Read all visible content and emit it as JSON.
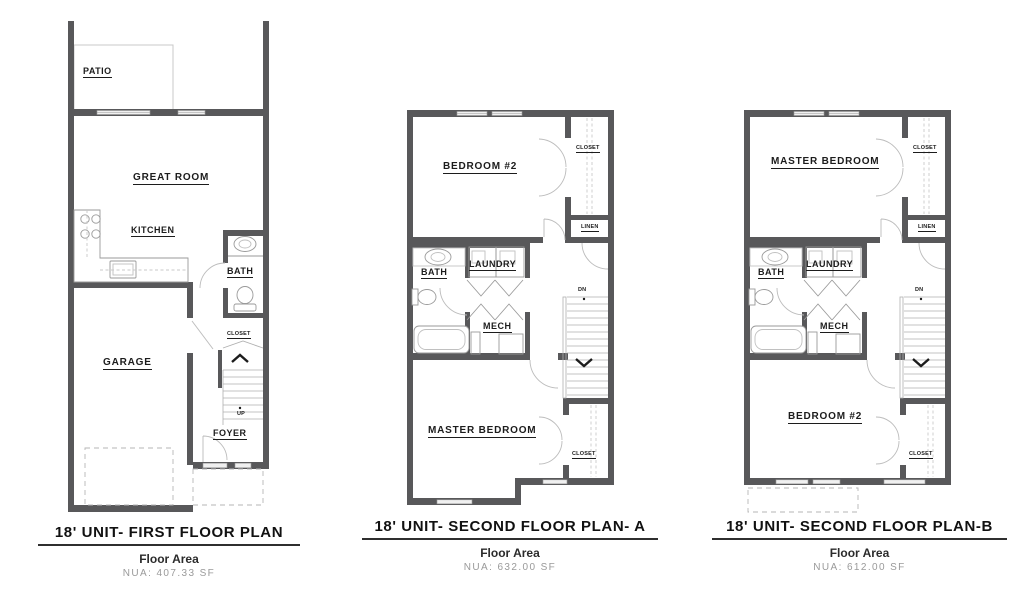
{
  "sheet": {
    "background": "#ffffff",
    "wall_color": "#58585a",
    "thin_line_color": "#a9a9a9",
    "label_color": "#1c1c1c",
    "muted_color": "#9a9a9a"
  },
  "plans": [
    {
      "id": "first-floor",
      "title": "18' UNIT- FIRST FLOOR PLAN",
      "floor_area_label": "Floor Area",
      "nua": "NUA: 407.33 SF",
      "rooms": {
        "patio": "PATIO",
        "great_room": "GREAT ROOM",
        "kitchen": "KITCHEN",
        "bath": "BATH",
        "closet": "CLOSET",
        "garage": "GARAGE",
        "foyer": "FOYER",
        "up": "UP"
      }
    },
    {
      "id": "second-floor-a",
      "title": "18' UNIT- SECOND FLOOR PLAN- A",
      "floor_area_label": "Floor Area",
      "nua": "NUA: 632.00 SF",
      "rooms": {
        "bedroom2": "BEDROOM #2",
        "closet_top": "CLOSET",
        "linen": "LINEN",
        "bath": "BATH",
        "laundry": "LAUNDRY",
        "mech": "MECH",
        "dn": "DN",
        "master_bedroom": "MASTER BEDROOM",
        "closet_bottom": "CLOSET"
      }
    },
    {
      "id": "second-floor-b",
      "title": "18' UNIT- SECOND FLOOR PLAN-B",
      "floor_area_label": "Floor Area",
      "nua": "NUA: 612.00 SF",
      "rooms": {
        "master_bedroom": "MASTER BEDROOM",
        "closet_top": "CLOSET",
        "linen": "LINEN",
        "bath": "BATH",
        "laundry": "LAUNDRY",
        "mech": "MECH",
        "dn": "DN",
        "bedroom2": "BEDROOM #2",
        "closet_bottom": "CLOSET"
      }
    }
  ]
}
